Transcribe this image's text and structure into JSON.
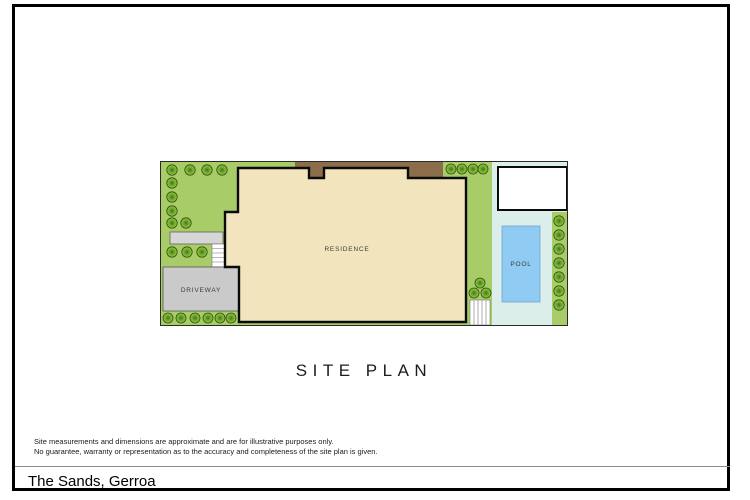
{
  "plan": {
    "title": "SITE PLAN",
    "labels": {
      "residence": "RESIDENCE",
      "driveway": "DRIVEWAY",
      "pool": "POOL"
    },
    "colors": {
      "grass": "#a8cd68",
      "tree_light": "#9ccc44",
      "tree_dark": "#4e7c1e",
      "residence_fill": "#f2e5be",
      "deck_brown": "#8b6d4a",
      "pool_water": "#8fcbf2",
      "pool_surround": "#dceeea",
      "driveway_gray": "#cacaca",
      "outline": "#000000"
    },
    "tree_count": 32
  },
  "footer": {
    "disclaimer_line1": "Site measurements and dimensions are approximate and are for illustrative purposes only.",
    "disclaimer_line2": "No guarantee, warranty or representation as to the accuracy and completeness of the site plan is given.",
    "property_title": "The Sands, Gerroa"
  }
}
